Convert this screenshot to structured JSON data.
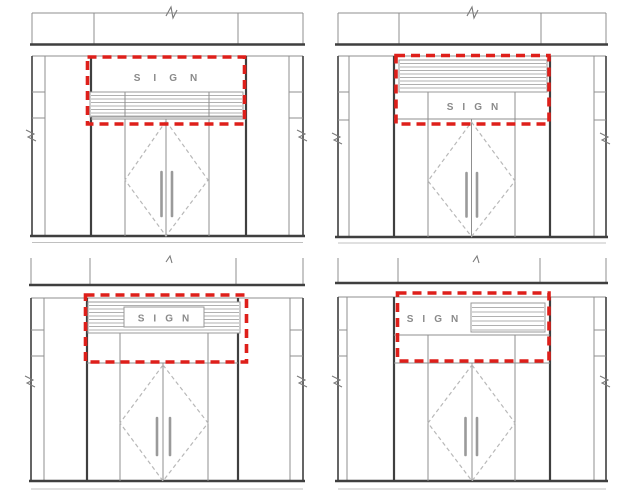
{
  "figure": {
    "panels": [
      {
        "id": "top-left",
        "sign_label": "SIGN"
      },
      {
        "id": "top-right",
        "sign_label": "SIGN"
      },
      {
        "id": "bottom-left",
        "sign_label": "SIGN"
      },
      {
        "id": "bottom-right",
        "sign_label": "SIGN"
      }
    ],
    "colors": {
      "highlight_red": "#de1f1a",
      "line_dark": "#3f3f3f",
      "line_light": "#8f8f8f",
      "hatch_gray": "#b0b0b0",
      "background": "#ffffff"
    }
  }
}
